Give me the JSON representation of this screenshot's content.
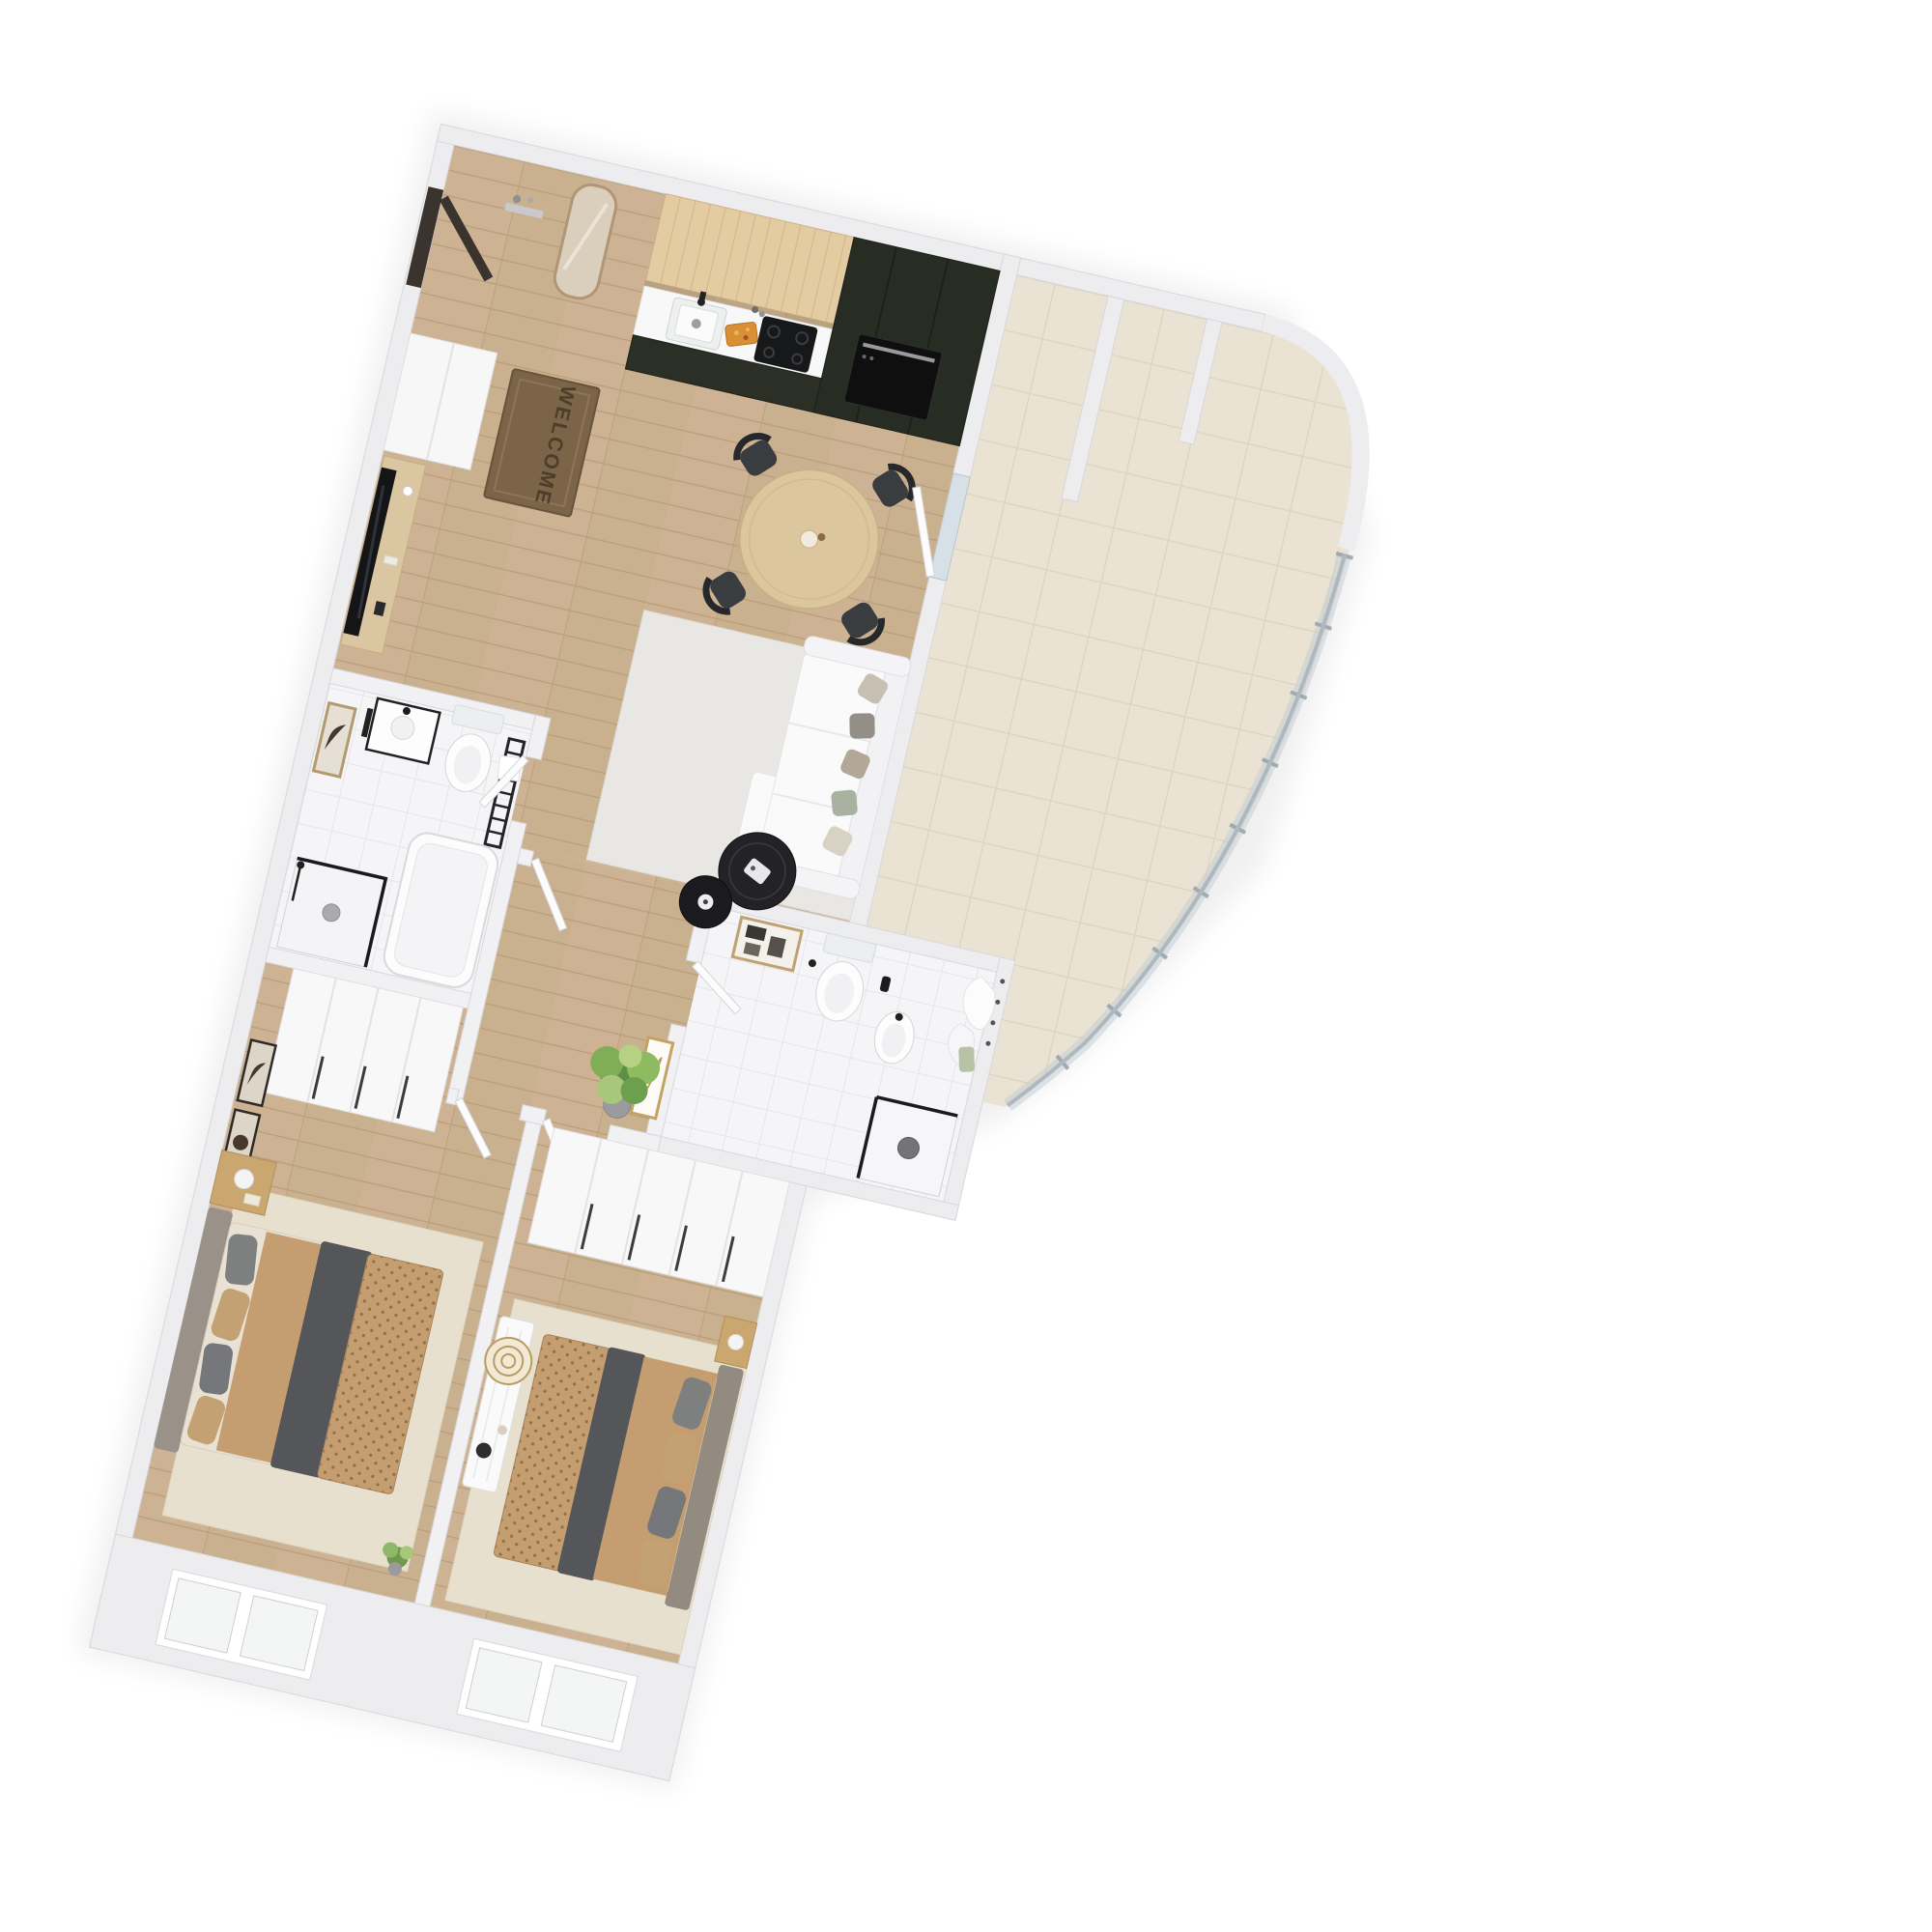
{
  "scene": {
    "type": "3d-apartment-floor-plan-rendering",
    "background": "#ffffff",
    "mat_text": "WELCOME",
    "view": "top-down dollhouse view, plan rotated about 13 degrees clockwise"
  },
  "palette": {
    "wall": "#ededef",
    "wall_edge": "#d8d8db",
    "wood_floor": "#cdb393",
    "wood_line": "#bb9f7c",
    "bath_tile": "#f5f5f7",
    "terrace_tile": "#eae3d3",
    "kitchen_upper_wood": "#e4cca2",
    "kitchen_dark_cabinet": "#282d24",
    "countertop": "#f8f8f9",
    "duvet_tan": "#c49e70",
    "duvet_dot": "#8f7045",
    "blanket_gray": "#54565a",
    "headboard_gray": "#9a9189",
    "rug_bedroom": "#e8e0cf",
    "rug_living": "#e8e7e4",
    "sofa_white": "#fafafa",
    "coffee_table_black": "#232327",
    "chair_black": "#3a3d40",
    "dining_table_wood": "#dcc69e",
    "glass_railing": "#c2ccd4",
    "gold_frame": "#c4a264",
    "plant_green": "#6f9a4e",
    "entry_door_dark": "#3a332e",
    "mat_brown": "#7b6448",
    "cutting_board_orange": "#d98f33"
  },
  "rooms": [
    {
      "id": "entry-hall",
      "name": "Entry hall",
      "furniture": [
        "entry-door",
        "wall-mirror",
        "wall-shelf",
        "welcome-mat",
        "wardrobe-cabinet"
      ]
    },
    {
      "id": "kitchen",
      "name": "Kitchen",
      "furniture": [
        "upper-cabinets-wood",
        "countertop",
        "kitchen-sink",
        "faucet",
        "bottles",
        "cutting-board",
        "cooktop",
        "tall-dark-cabinet",
        "built-in-oven"
      ]
    },
    {
      "id": "dining-area",
      "name": "Dining area",
      "furniture": [
        "round-dining-table",
        "dining-chair x4",
        "table-centerpiece"
      ]
    },
    {
      "id": "living-area",
      "name": "Living area",
      "furniture": [
        "area-rug",
        "sofa-with-chaise",
        "throw-pillows",
        "nesting-coffee-tables",
        "tv",
        "media-console",
        "terrace-door"
      ]
    },
    {
      "id": "bathroom-1",
      "name": "Bathroom 1",
      "furniture": [
        "wall-art",
        "washbasin",
        "wall-hung-toilet",
        "towel-radiator",
        "walk-in-shower",
        "bathtub"
      ]
    },
    {
      "id": "hallway",
      "name": "Hallway",
      "furniture": [
        "open-door x4",
        "gold-frame-art",
        "potted-plant"
      ]
    },
    {
      "id": "bathroom-2",
      "name": "Bathroom 2",
      "furniture": [
        "wall-art",
        "wall-hung-toilet",
        "bidet",
        "walk-in-shower",
        "towel-hooks",
        "towels"
      ]
    },
    {
      "id": "bedroom-1",
      "name": "Bedroom 1",
      "furniture": [
        "wardrobe",
        "double-bed",
        "pillows",
        "tan-duvet",
        "gray-blanket",
        "nightstand",
        "table-lamp",
        "wall-frames",
        "area-rug",
        "window x2",
        "small-plant"
      ]
    },
    {
      "id": "bedroom-2",
      "name": "Bedroom 2",
      "furniture": [
        "wardrobe",
        "double-bed",
        "pillows",
        "tan-duvet",
        "gray-blanket",
        "nightstand",
        "console-dresser",
        "gold-circle-decor",
        "vase",
        "area-rug",
        "window x2"
      ]
    },
    {
      "id": "terrace",
      "name": "Terrace",
      "furniture": [
        "tiled-floor",
        "partition-walls",
        "curved-glass-railing"
      ]
    }
  ]
}
